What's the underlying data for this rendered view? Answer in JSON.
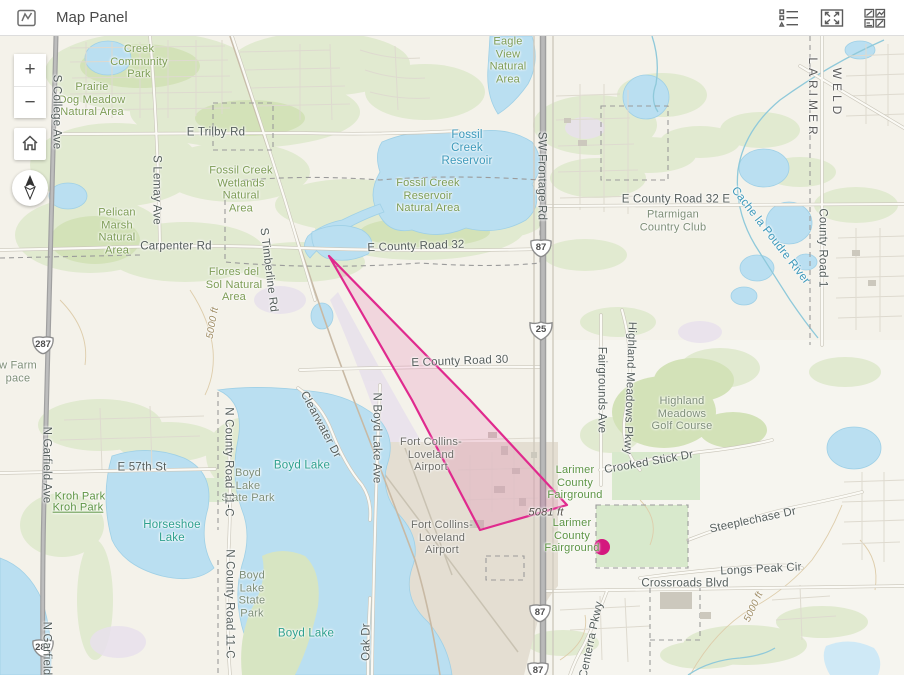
{
  "header": {
    "title": "Map Panel",
    "left_icon": "map-panel-icon",
    "actions": [
      {
        "icon": "legend-list-icon"
      },
      {
        "icon": "expand-icon"
      },
      {
        "icon": "quad-layout-icon"
      }
    ]
  },
  "controls": {
    "zoom_in": "+",
    "zoom_out": "−",
    "home_icon": "home-icon",
    "compass_icon": "compass-north-icon"
  },
  "shields": [
    {
      "label": "287",
      "type": "us",
      "x": 43,
      "y": 345
    },
    {
      "label": "287",
      "type": "us",
      "x": 43,
      "y": 648
    },
    {
      "label": "87",
      "type": "us",
      "x": 541,
      "y": 248
    },
    {
      "label": "25",
      "type": "interstate",
      "x": 541,
      "y": 330
    },
    {
      "label": "87",
      "type": "us",
      "x": 540,
      "y": 613
    },
    {
      "label": "87",
      "type": "us",
      "x": 538,
      "y": 671
    }
  ],
  "overlay": {
    "polygon": {
      "points": [
        [
          329,
          256
        ],
        [
          470,
          400
        ],
        [
          567,
          505
        ],
        [
          480,
          530
        ],
        [
          412,
          400
        ]
      ],
      "stroke": "#e02a8e",
      "fill": "rgba(232,70,155,0.16)",
      "stroke_width": 2.2
    },
    "point": {
      "x": 602,
      "y": 547,
      "r": 8,
      "color": "#d4187e"
    }
  },
  "map": {
    "labels": [
      {
        "text": "Creek\nCommunity\nPark",
        "x": 139,
        "y": 62,
        "cls": "g"
      },
      {
        "text": "Prairie\nDog Meadow\nNatural Area",
        "x": 92,
        "y": 100,
        "cls": "g"
      },
      {
        "text": "E Trilby Rd",
        "x": 216,
        "y": 133,
        "cls": "rd"
      },
      {
        "text": "Eagle\nView\nNatural\nArea",
        "x": 508,
        "y": 61,
        "cls": "g"
      },
      {
        "text": "Fossil\nCreek\nReservoir",
        "x": 467,
        "y": 149,
        "cls": "wb"
      },
      {
        "text": "Fossil Creek\nWetlands\nNatural\nArea",
        "x": 241,
        "y": 190,
        "cls": "g"
      },
      {
        "text": "Fossil Creek\nReservoir\nNatural Area",
        "x": 428,
        "y": 196,
        "cls": "g"
      },
      {
        "text": "SW Frontage Rd",
        "x": 541,
        "y": 176,
        "cls": "rd",
        "rotate": 90
      },
      {
        "text": "E County Road 32 E",
        "x": 676,
        "y": 200,
        "cls": "rd"
      },
      {
        "text": "Ptarmigan\nCountry Club",
        "x": 673,
        "y": 221,
        "cls": "ar"
      },
      {
        "text": "LARIMER",
        "x": 812,
        "y": 98,
        "cls": "county",
        "rotate": 90
      },
      {
        "text": "WELD",
        "x": 836,
        "y": 93,
        "cls": "county",
        "rotate": 90
      },
      {
        "text": "Cache la Poudre River",
        "x": 770,
        "y": 236,
        "cls": "wb",
        "rotate": 52
      },
      {
        "text": "County Road 1",
        "x": 822,
        "y": 248,
        "cls": "rd",
        "rotate": 90
      },
      {
        "text": "Pelican\nMarsh\nNatural\nArea",
        "x": 117,
        "y": 232,
        "cls": "g"
      },
      {
        "text": "S Lemay Ave",
        "x": 156,
        "y": 190,
        "cls": "rd",
        "rotate": 90
      },
      {
        "text": "Carpenter Rd",
        "x": 176,
        "y": 247,
        "cls": "rd"
      },
      {
        "text": "E County Road 32",
        "x": 416,
        "y": 247,
        "cls": "rd",
        "rotate": -2
      },
      {
        "text": "S Timberline Rd",
        "x": 268,
        "y": 270,
        "cls": "rd",
        "rotate": 83
      },
      {
        "text": "Flores del\nSol Natural\nArea",
        "x": 234,
        "y": 285,
        "cls": "g"
      },
      {
        "text": "w Farm\npace",
        "x": 18,
        "y": 372,
        "cls": "ar"
      },
      {
        "text": "5000 ft",
        "x": 213,
        "y": 323,
        "cls": "ct",
        "rotate": -80
      },
      {
        "text": "S College Ave",
        "x": 56,
        "y": 112,
        "cls": "rd",
        "rotate": 90
      },
      {
        "text": "N Garfield Ave",
        "x": 46,
        "y": 465,
        "cls": "rd",
        "rotate": 90
      },
      {
        "text": "N Garfield Ave",
        "x": 46,
        "y": 660,
        "cls": "rd",
        "rotate": 90
      },
      {
        "text": "E 57th St",
        "x": 142,
        "y": 468,
        "cls": "rd"
      },
      {
        "text": "Kroh Park",
        "x": 80,
        "y": 497,
        "cls": "g2"
      },
      {
        "text": "Kroh Park",
        "x": 78,
        "y": 508,
        "cls": "g2 link"
      },
      {
        "text": "Horseshoe\nLake",
        "x": 172,
        "y": 532,
        "cls": "wt"
      },
      {
        "text": "Boyd Lake",
        "x": 302,
        "y": 466,
        "cls": "wt"
      },
      {
        "text": "Boyd\nLake\nState Park",
        "x": 248,
        "y": 486,
        "cls": "ar"
      },
      {
        "text": "N County Road 11-C",
        "x": 228,
        "y": 462,
        "cls": "rd",
        "rotate": 90
      },
      {
        "text": "Clearwater Dr",
        "x": 320,
        "y": 425,
        "cls": "rd",
        "rotate": 62
      },
      {
        "text": "N Boyd Lake Ave",
        "x": 376,
        "y": 438,
        "cls": "rd",
        "rotate": 90
      },
      {
        "text": "Fort Collins-\nLoveland\nAirport",
        "x": 431,
        "y": 455,
        "cls": "poi"
      },
      {
        "text": "E County Road 30",
        "x": 460,
        "y": 362,
        "cls": "rd",
        "rotate": -2
      },
      {
        "text": "Fairgrounds Ave",
        "x": 601,
        "y": 390,
        "cls": "rd",
        "rotate": 90
      },
      {
        "text": "Highland Meadows Pkwy",
        "x": 629,
        "y": 388,
        "cls": "rd",
        "rotate": 92
      },
      {
        "text": "Highland\nMeadows\nGolf Course",
        "x": 682,
        "y": 414,
        "cls": "ar"
      },
      {
        "text": "Crooked Stick Dr",
        "x": 649,
        "y": 463,
        "cls": "rd",
        "rotate": -10
      },
      {
        "text": "Larimer\nCounty\nFairground",
        "x": 575,
        "y": 483,
        "cls": "g2"
      },
      {
        "text": "5081 ft",
        "x": 546,
        "y": 513,
        "cls": "el"
      },
      {
        "text": "Larimer\nCounty\nFairground",
        "x": 572,
        "y": 536,
        "cls": "g2"
      },
      {
        "text": "Fort Collins-\nLoveland\nAirport",
        "x": 442,
        "y": 538,
        "cls": "poi"
      },
      {
        "text": "Steeplechase Dr",
        "x": 753,
        "y": 521,
        "cls": "rd",
        "rotate": -12
      },
      {
        "text": "Longs Peak Cir",
        "x": 761,
        "y": 570,
        "cls": "rd",
        "rotate": -3
      },
      {
        "text": "Crossroads Blvd",
        "x": 685,
        "y": 584,
        "cls": "rd"
      },
      {
        "text": "5000 ft",
        "x": 754,
        "y": 607,
        "cls": "ct",
        "rotate": -65
      },
      {
        "text": "Centerra Pkwy",
        "x": 592,
        "y": 640,
        "cls": "rd",
        "rotate": -78
      },
      {
        "text": "Oak Dr",
        "x": 367,
        "y": 642,
        "cls": "rd",
        "rotate": -90
      },
      {
        "text": "Boyd\nLake\nState\nPark",
        "x": 252,
        "y": 595,
        "cls": "ar"
      },
      {
        "text": "Boyd Lake",
        "x": 306,
        "y": 634,
        "cls": "wt"
      },
      {
        "text": "N County Road 11-C",
        "x": 229,
        "y": 604,
        "cls": "rd",
        "rotate": 90
      }
    ]
  }
}
